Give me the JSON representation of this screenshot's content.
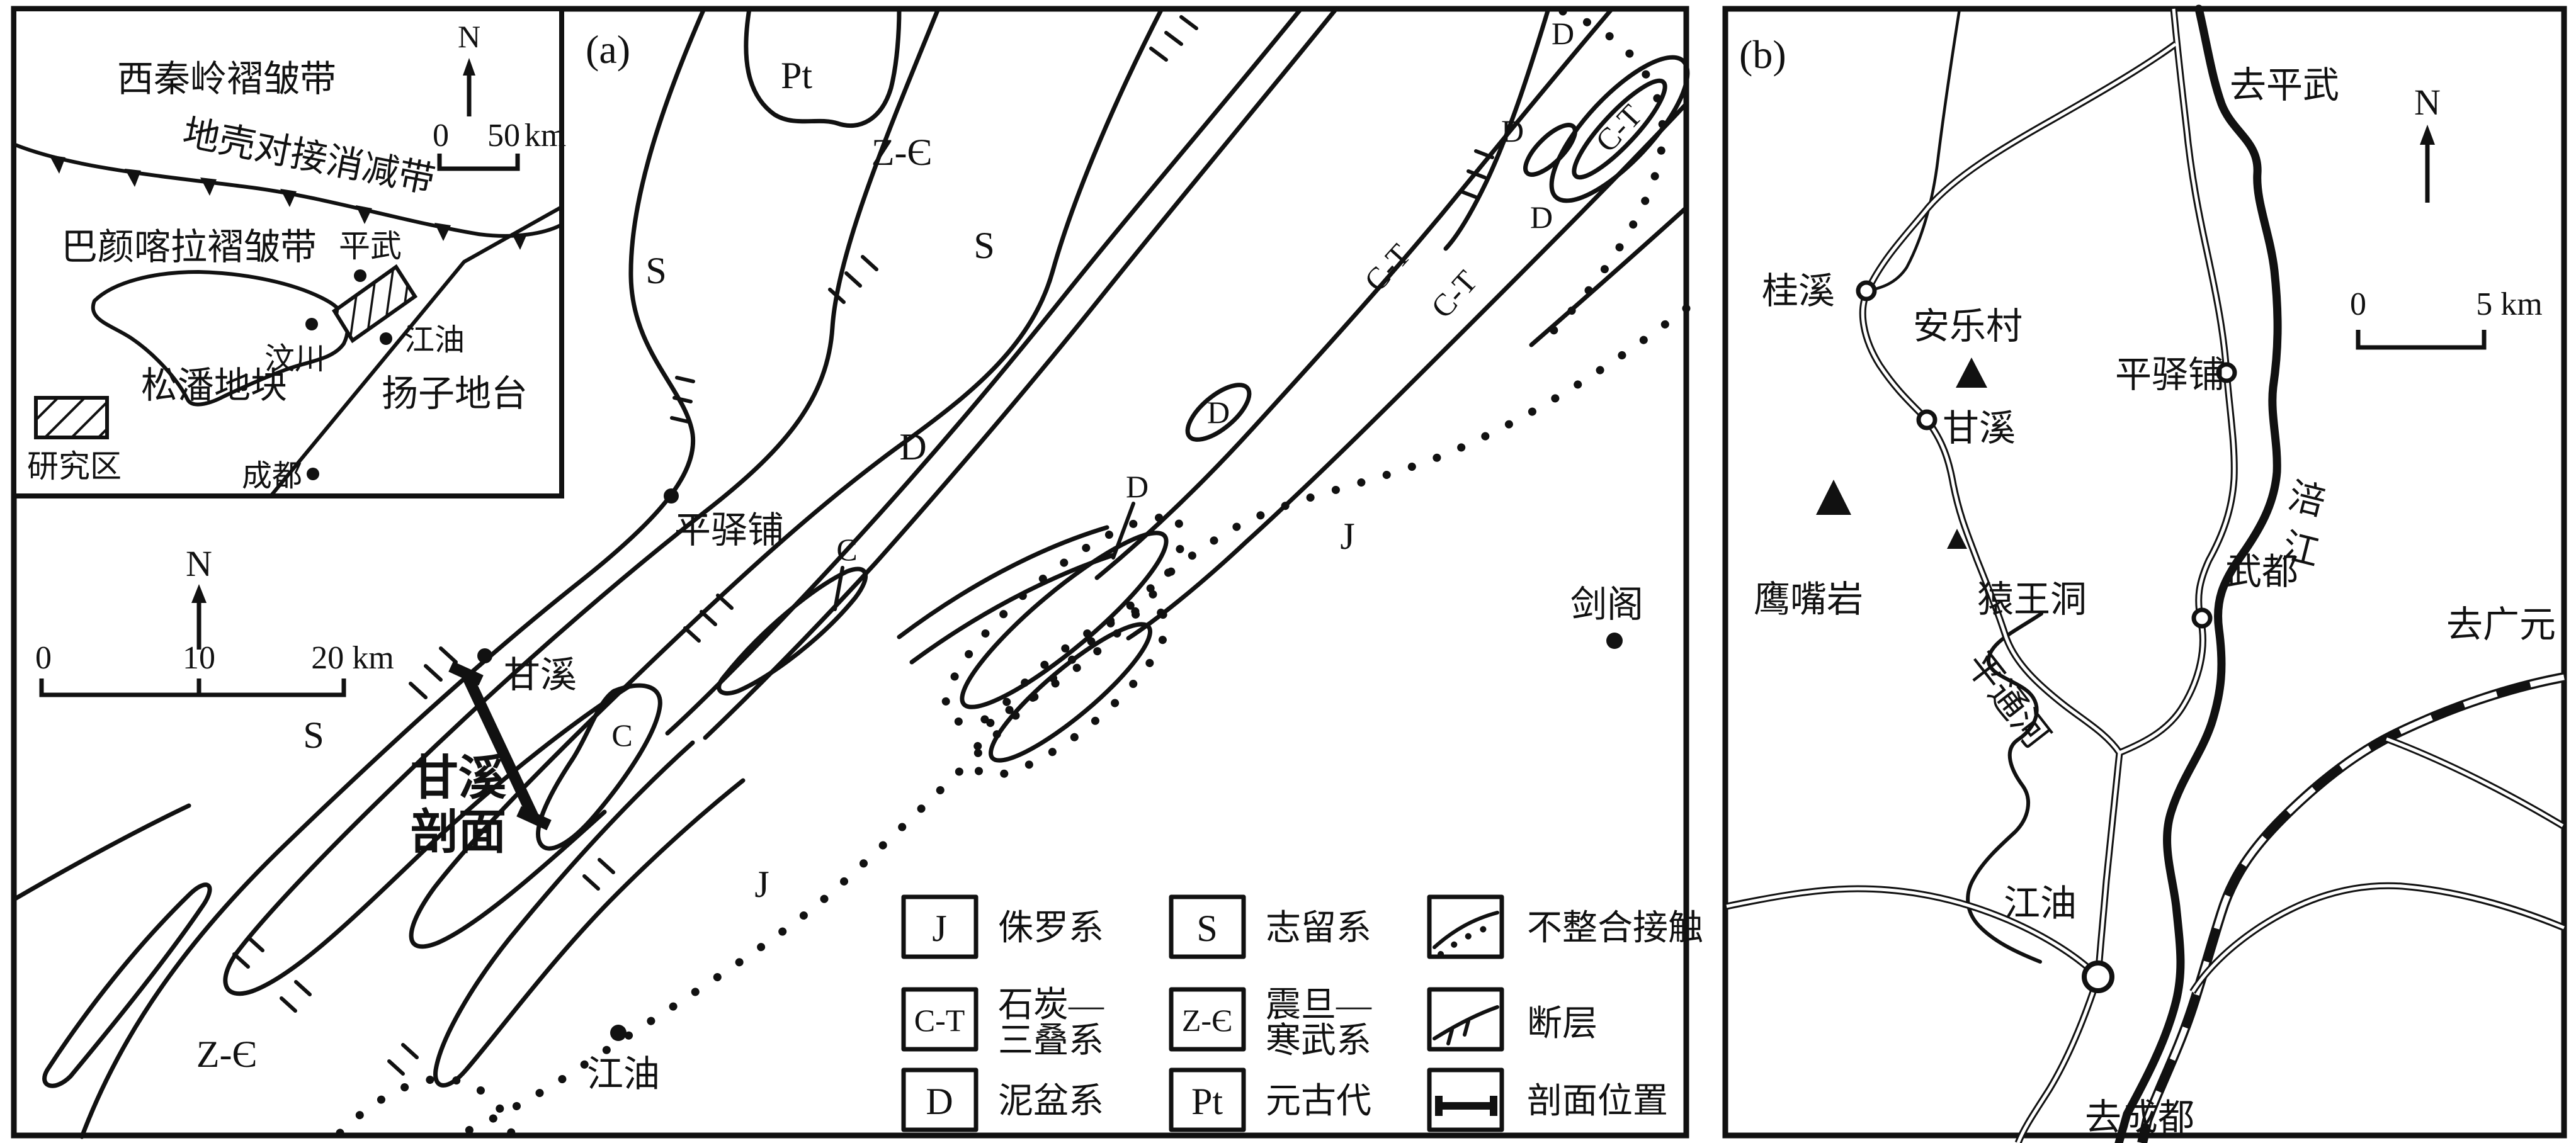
{
  "figure": {
    "background": "#ffffff",
    "ink_color": "#111111",
    "panel_a_tag": "(a)",
    "panel_b_tag": "(b)"
  },
  "inset": {
    "west_qinling": "西秦岭褶皱带",
    "suture": "地壳对接消减带",
    "bayan_har": "巴颜喀拉褶皱带",
    "songpan": "松潘地块",
    "yangtze": "扬子地台",
    "study_area": "研究区",
    "towns": {
      "pingwu": "平武",
      "wenchuan": "汶川",
      "jiangyou": "江油",
      "chengdu": "成都"
    },
    "north": "N",
    "scale": {
      "t0": "0",
      "t50": "50",
      "unit": "km"
    }
  },
  "panel_a": {
    "north": "N",
    "scale": {
      "t0": "0",
      "t10": "10",
      "t20": "20 km"
    },
    "units": {
      "pt": "Pt",
      "zc_top": "Z-Є",
      "s_left": "S",
      "s_mid": "S",
      "s_sw": "S",
      "d_main": "D",
      "d_lens": "D",
      "d_mid": "D",
      "c_upper": "C",
      "c_lower": "C",
      "ct_band_1": "C-T",
      "ct_band_2": "C-T",
      "ct_lens": "C-T",
      "d_ne1": "D",
      "d_ne2": "D",
      "d_ne3": "D",
      "j_east": "J",
      "j_south": "J",
      "zc_sw": "Z-Є"
    },
    "towns": {
      "pingyipu": "平驿铺",
      "ganxi": "甘溪",
      "jiange": "剑阁",
      "jiangyou": "江油"
    },
    "section_label_line1": "甘溪",
    "section_label_line2": "剖面",
    "legend": {
      "j_sym": "J",
      "j_label": "侏罗系",
      "s_sym": "S",
      "s_label": "志留系",
      "unconformity_label": "不整合接触",
      "ct_sym": "C-T",
      "ct_label1": "石炭—",
      "ct_label2": "三叠系",
      "zc_sym": "Z-Є",
      "zc_label1": "震旦—",
      "zc_label2": "寒武系",
      "fault_label": "断层",
      "d_sym": "D",
      "d_label": "泥盆系",
      "pt_sym": "Pt",
      "pt_label": "元古代",
      "section_label": "剖面位置"
    }
  },
  "panel_b": {
    "north": "N",
    "scale": {
      "t0": "0",
      "t5": "5 km"
    },
    "roads": {
      "to_pingwu": "去平武",
      "to_guangyuan": "去广元",
      "to_chengdu": "去成都"
    },
    "rivers": {
      "fujiang_char1": "涪",
      "fujiang_char2": "江",
      "pingtonghe": "平通河"
    },
    "places": {
      "pingyipu": "平驿铺",
      "guixi": "桂溪",
      "anlecun": "安乐村",
      "ganxi": "甘溪",
      "yingzuiyan": "鹰嘴岩",
      "yuanwangdong": "猿王洞",
      "wudu": "武都",
      "jiangyou": "江油"
    }
  }
}
